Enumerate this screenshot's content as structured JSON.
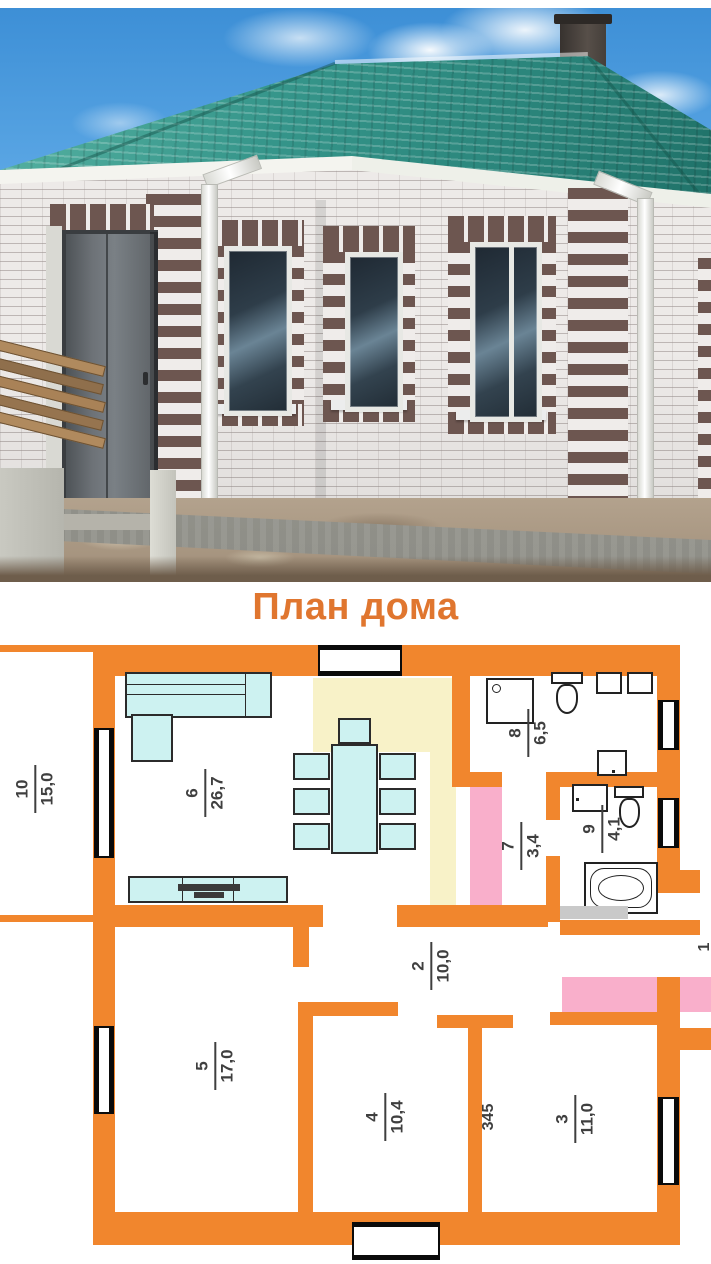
{
  "title": "План дома",
  "colors": {
    "wall_orange": "#F1862D",
    "title_orange": "#E0762F",
    "furniture_cyan": "#CDF2F1",
    "furniture_border": "#2B2B2B",
    "kitchen_yellow": "#F8F2C8",
    "wardrobe_pink": "#F9AFCB",
    "label_gray": "#3F3F3F",
    "roof_teal": "#2F8E84",
    "sky_blue": "#55A3E2",
    "brick_white": "#EDEAE8",
    "brick_brown": "#6D5650"
  },
  "plan": {
    "rooms": [
      {
        "number": "10",
        "area": "15,0"
      },
      {
        "number": "6",
        "area": "26,7"
      },
      {
        "number": "8",
        "area": "6,5"
      },
      {
        "number": "7",
        "area": "3,4"
      },
      {
        "number": "9",
        "area": "4,1"
      },
      {
        "number": "2",
        "area": "10,0"
      },
      {
        "number": "5",
        "area": "17,0"
      },
      {
        "number": "4",
        "area": "10,4"
      },
      {
        "number": "3",
        "area": "11,0"
      }
    ],
    "wall_dimension": "345",
    "cutoff_room_number": "1"
  }
}
